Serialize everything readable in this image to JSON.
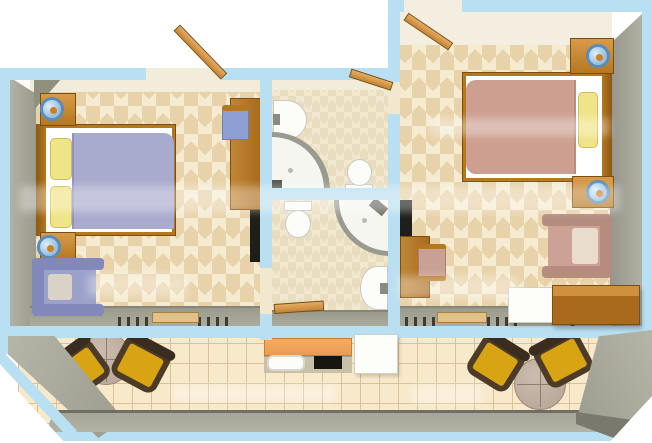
{
  "document": {
    "kind": "3D top-down floor plan of a two-bedroom apartment with two bathrooms, kitchenette and balcony",
    "width_px": 652,
    "height_px": 443
  },
  "areas": {
    "bedroom_left": {
      "label": "left bedroom",
      "furniture": [
        "double-bed-lavender-cover",
        "yellow-pillow x2",
        "nightstand-with-lamp x2",
        "lavender-armchair",
        "desk-with-blue-chair",
        "dark-shelf-unit",
        "radiator x2",
        "balcony-door-threshold",
        "entry-door"
      ]
    },
    "bathroom_upper": {
      "label": "upper bathroom",
      "fixtures": [
        "washbasin",
        "corner-shower",
        "toilet",
        "door"
      ]
    },
    "bathroom_lower": {
      "label": "lower bathroom",
      "fixtures": [
        "toilet",
        "corner-shower",
        "washbasin",
        "door"
      ]
    },
    "bedroom_right": {
      "label": "right bedroom",
      "furniture": [
        "double-bed-beige-cover",
        "yellow-pillow",
        "nightstand-with-lamp x2",
        "desk-with-chair",
        "pink-armchair",
        "white-minibar",
        "wooden-sideboard",
        "dark-shelf-unit",
        "radiator x2",
        "balcony-door-threshold",
        "entry-door"
      ]
    },
    "kitchenette": {
      "label": "balcony kitchenette",
      "fixtures": [
        "orange-counter",
        "sink",
        "cooktop",
        "refrigerator"
      ]
    },
    "balcony": {
      "label": "balcony terrace",
      "furniture": [
        "round-table-with-two-chairs-left",
        "round-table-with-two-chairs-right"
      ]
    }
  },
  "colors": {
    "wall_blue": "#b9e0f2",
    "gray_wall": "#a6a699",
    "gray_wall_dark": "#8e8e81",
    "face_cream": "#f2ecda",
    "face_cream_light": "#f4eee0",
    "tile_light": "#f5ebd0",
    "tile_dark": "#e8d2a9",
    "bath_tile_light": "#f2e8d0",
    "bath_tile_dark": "#e9ddc0",
    "balcony_tile": "#f8e9cb",
    "balcony_grid": "#ddc096",
    "wood": "#b5781f",
    "wood_light": "#d99b4a",
    "wood_dark": "#7a4e10",
    "wood_door": "#c68434",
    "duvet_left": "#a9abce",
    "duvet_right": "#cd9f90",
    "pillow_yellow": "#f0e488",
    "mattress_white": "#ffffff",
    "lamp_blue": "#96c0e0",
    "lamp_ring": "#5b8cb8",
    "lamp_dot": "#d07f1f",
    "armchair_left": "#9ba1c9",
    "armchair_left_dark": "#8289ba",
    "armchair_right": "#cba295",
    "armchair_right_dark": "#b68c7f",
    "chair_left_blue": "#8d9ed3",
    "chair_right_pink": "#c9a094",
    "tv_black": "#1e1e1a",
    "fixture_white": "#fcfcf9",
    "fixture_border": "#c9c9c0",
    "shower_rim": "#9a9a90",
    "shower_tray": "#f6f6f1",
    "counter_orange": "#ec9c52",
    "counter_face": "#c9c0aa",
    "cooktop_black": "#16160f",
    "fridge_white": "#fdfdfa",
    "table_top": "#bcab9d",
    "table_line": "#8e7d6e",
    "seat_yellow": "#d9a413",
    "chair_frame": "#4c3b27",
    "threshold_tan": "#dfc189",
    "radiator_dark": "#3c3c34"
  }
}
